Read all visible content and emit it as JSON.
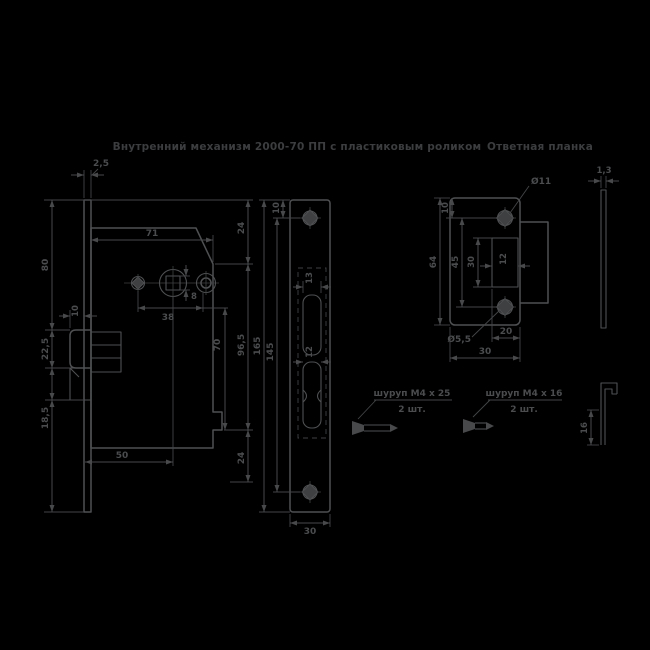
{
  "colors": {
    "background": "#000000",
    "line": "#4e5052",
    "dim_line": "#48494b",
    "text": "#4a4c4e",
    "title_text": "#3b3d3f"
  },
  "titles": {
    "main": "Внутренний механизм 2000-70 ПП с пластиковым роликом",
    "strike": "Ответная планка"
  },
  "lock_view": {
    "dims": {
      "plate_thickness": "2,5",
      "body_width": "71",
      "offset_top": "24",
      "height_outer": "96,5",
      "height_inner": "70",
      "offset_bottom": "24",
      "left_upper": "80",
      "latch_height": "22,5",
      "lower_height": "18,5",
      "backset": "50",
      "hole_spacing": "38",
      "spindle_square": "8",
      "latch_protrusion": "10"
    }
  },
  "faceplate_view": {
    "dims": {
      "height": "165",
      "hole_spacing": "145",
      "top_hole_offset": "10",
      "latch_slot_width": "13",
      "lower_slot_width": "12",
      "plate_width": "30"
    }
  },
  "strike_view": {
    "dims": {
      "countersink_dia": "Ø11",
      "screw_hole_dia": "Ø5,5",
      "height": "64",
      "hole_spacing": "45",
      "cutout_height": "30",
      "cutout_width": "12",
      "top_hole_offset": "10",
      "cutout_to_edge": "20",
      "plate_width": "30"
    }
  },
  "side_views": {
    "plate_thickness": "1,3",
    "lip_height": "16"
  },
  "screws": {
    "lock": {
      "label": "шуруп М4 х 25",
      "qty": "2 шт."
    },
    "strike": {
      "label": "шуруп М4 х 16",
      "qty": "2 шт."
    }
  }
}
